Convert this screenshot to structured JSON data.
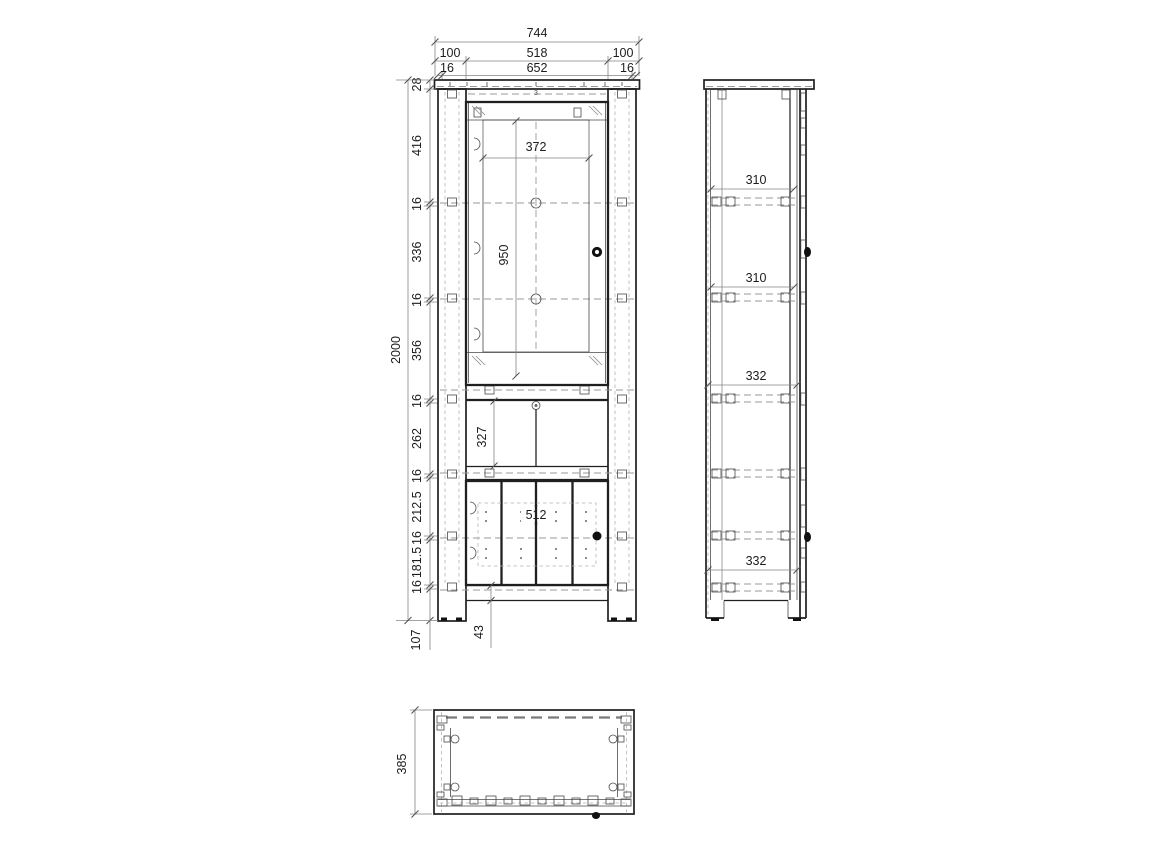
{
  "front": {
    "w_total": "744",
    "w_row2": [
      "100",
      "518",
      "100"
    ],
    "w_row3": [
      "16",
      "652",
      "16"
    ],
    "h_total": "2000",
    "chain": [
      "28",
      "416",
      "16",
      "336",
      "16",
      "356",
      "16",
      "262",
      "16",
      "212.5",
      "16",
      "181.5",
      "16"
    ],
    "leg_h": "107",
    "glass_w": "372",
    "glass_h": "950",
    "open_h": "327",
    "door_w": "512",
    "plinth_h": "43",
    "fitting_mark": "3"
  },
  "side": {
    "shelf_depths": [
      "310",
      "310",
      "332",
      "332"
    ]
  },
  "top": {
    "depth": "385"
  }
}
